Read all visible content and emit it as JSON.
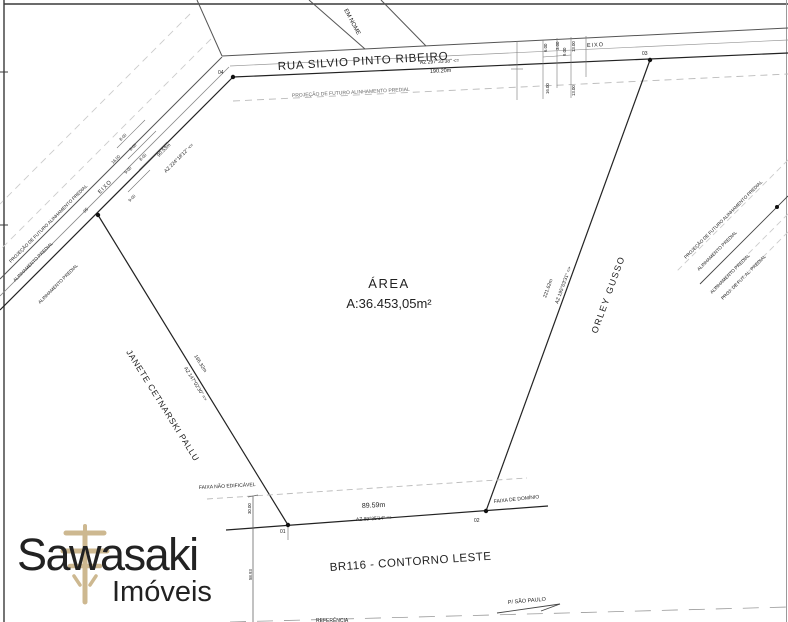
{
  "streets": {
    "rua_silvio": "RUA SILVIO PINTO RIBEIRO",
    "rua_sem_nome": "EM NOME",
    "br116": "BR116 - CONTORNO LESTE",
    "p_sao_paulo": "P/ SÃO PAULO",
    "referencia": "REFERÊNCIA"
  },
  "area": {
    "label": "ÁREA",
    "value": "A:36.453,05m²"
  },
  "axis": {
    "top": "EIXO",
    "left": "EIXO"
  },
  "boundaries": {
    "top": {
      "azimuth": "AZ 297°33'38\" <=",
      "length": "190.20m"
    },
    "left_upper": {
      "azimuth": "AZ 224°18'12\" <=",
      "length": "90.53m"
    },
    "left_lower": {
      "azimuth": "AZ 147°02'30\" =>",
      "length": "166.32m",
      "owner": "JANETE CETNARSKI PALLU"
    },
    "right": {
      "azimuth": "AZ 195°03'31\" =>",
      "length": "221.62m",
      "owner": "ORLEY GUSSO"
    },
    "bottom": {
      "azimuth": "AZ 89°35'14\" =>",
      "length": "89.59m"
    }
  },
  "points": {
    "p1": "01",
    "p2": "02",
    "p3": "03",
    "p4": "04",
    "p5": "05"
  },
  "alignments": {
    "projecao_top": "PROJEÇÃO DE FUTURO ALINHAMENTO PREDIAL",
    "left": [
      "PROJEÇÃO DE FUTURO ALINHAMENTO PREDIAL",
      "ALINHAMENTO PREDIAL",
      "ALINHAMENTO PREDIAL"
    ],
    "right": [
      "PROJEÇÃO DE FUTURO ALINHAMENTO PREDIAL",
      "ALINHAMENTO PREDIAL",
      "ALINHAMENTO PREDIAL",
      "PROJ. DE FUT. AL. PREDIAL"
    ]
  },
  "faixas": {
    "nao_edificavel": "FAIXA NÃO EDIFICÁVEL",
    "dominio": "FAIXA DE DOMÍNIO"
  },
  "dims": {
    "top_road": [
      "6.00",
      "3.00",
      "9.00",
      "13.00",
      "16.00",
      "13.00"
    ],
    "left_road": [
      "8.00",
      "6.00",
      "8.00",
      "16.00",
      "9.00",
      "9.00"
    ],
    "bottom": [
      "30.00",
      "58.93"
    ]
  },
  "logo": {
    "name": "Sawasaki",
    "segment": "Imóveis"
  },
  "colors": {
    "line": "#222222",
    "light": "#bbbbbb",
    "logo_gray": "#8a8a8a",
    "logo_gold": "#c9b287"
  }
}
